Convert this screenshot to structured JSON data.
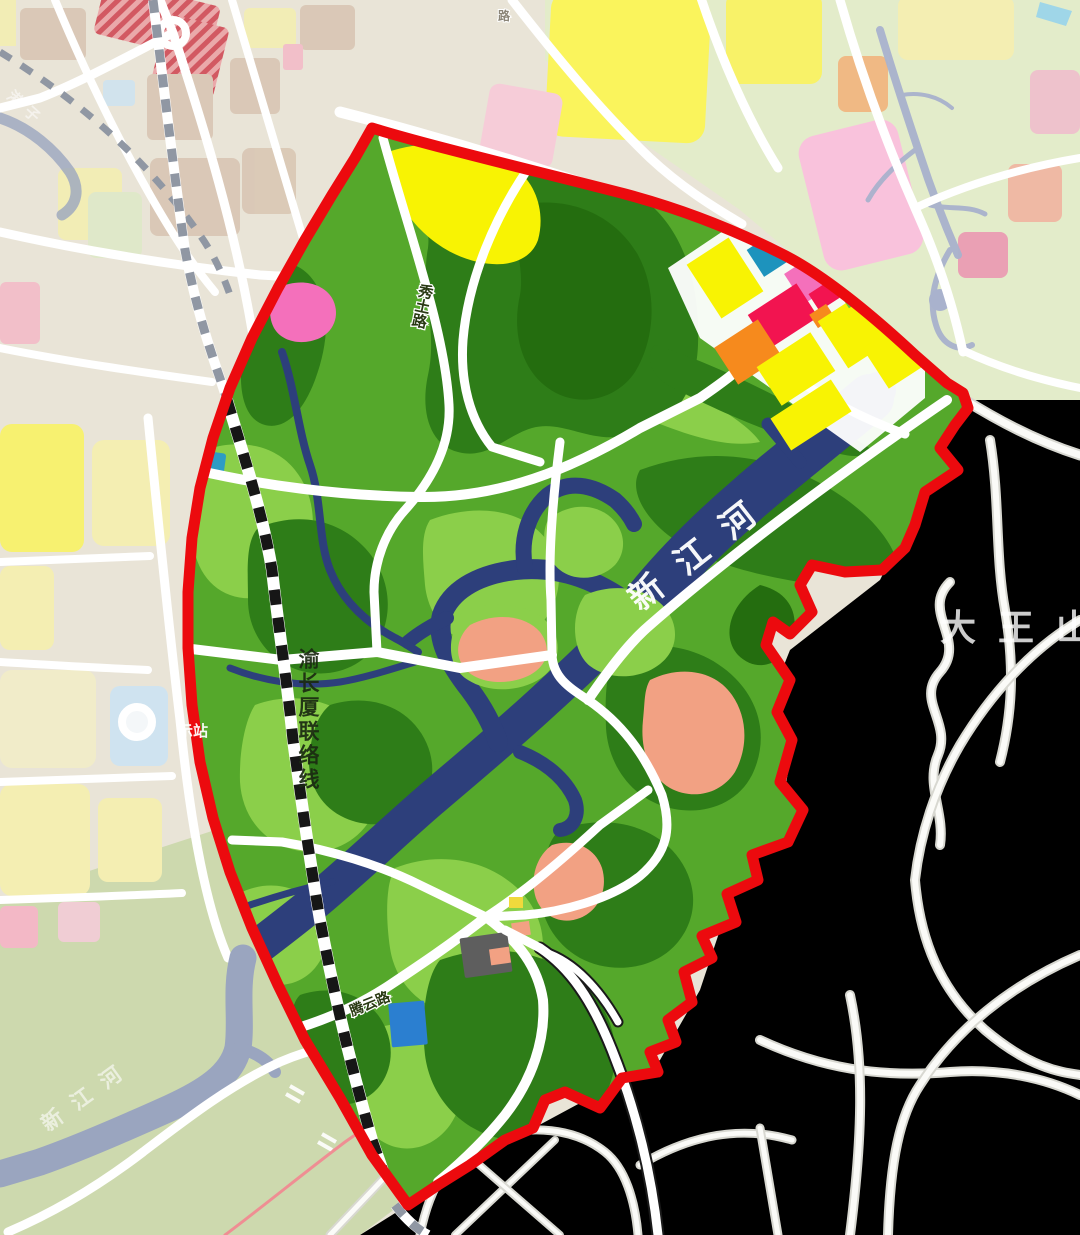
{
  "labels": {
    "river_main": "新江河",
    "river_sw": "新江河",
    "railway_line": "渝长厦联络线",
    "mountain": "大王山",
    "road_xiutu": "秀土路",
    "road_tengyun": "腾云路",
    "station": "示站",
    "road_tiny": "路",
    "stream_tl": "港子"
  },
  "colors": {
    "boundary-red": "#ec0a0e",
    "river-navy": "#2d3f7b",
    "river-muted": "#9aa5bf",
    "green-base": "#55a82b",
    "green-light": "#8bcf4a",
    "green-dark": "#2e7d18",
    "green-darker": "#246d0f",
    "rail-black": "#161616",
    "rail-gray": "#9097a3",
    "yellow-zone": "#f8f303",
    "yellow-bright": "#faf45c",
    "yellow-pale": "#f4eeb2",
    "pink-zone": "#f470bb",
    "pink-big": "#f9c2dc",
    "pink-pale": "#f6ccd8",
    "crimson": "#f21450",
    "orange-zone": "#f68a1d",
    "teal-zone": "#1d93bd",
    "salmon": "#f2a183",
    "blue-block": "#2b7fd0",
    "gray-block": "#5e5e5e",
    "lightblue-block": "#cfe3f0",
    "tan-block": "#d9c6b4",
    "outside-tl": "#e9e4d7",
    "outside-green": "#e3ecca",
    "outside-sage": "#cdd9ae",
    "outside-pale": "#ececе7",
    "pink-line": "#f5808e",
    "stripe-bg": "#eba3a6",
    "stripe-red": "#d04a56",
    "wetland": "#a9b2cd"
  }
}
